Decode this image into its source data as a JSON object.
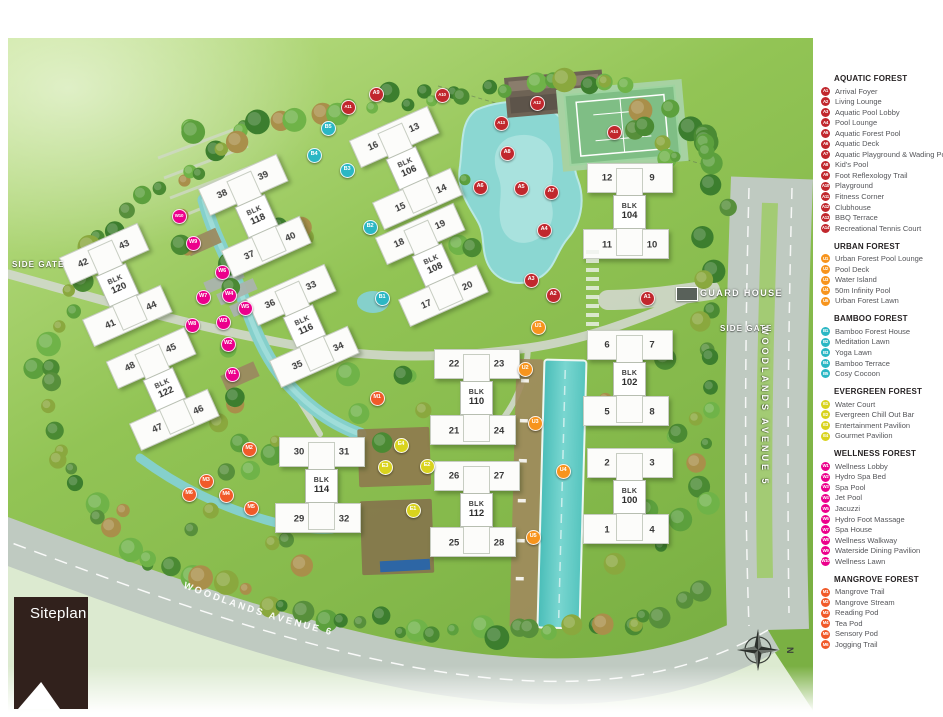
{
  "page": {
    "siteplan_label": "Siteplan"
  },
  "map": {
    "labels": {
      "guard_house": "GUARD HOUSE",
      "side_gate_right": "SIDE GATE",
      "side_gate_left": "SIDE GATE",
      "avenue5": "WOODLANDS AVENUE 5",
      "avenue6": "WOODLANDS AVENUE 6",
      "north": "N",
      "blk_prefix": "BLK"
    },
    "blocks": [
      {
        "number": "120",
        "x": 110,
        "y": 247,
        "rot": -24,
        "units": [
          "42",
          "43",
          "41",
          "44"
        ]
      },
      {
        "number": "122",
        "x": 157,
        "y": 351,
        "rot": -24,
        "units": [
          "48",
          "45",
          "47",
          "46"
        ]
      },
      {
        "number": "118",
        "x": 249,
        "y": 178,
        "rot": -24,
        "units": [
          "38",
          "39",
          "37",
          "40"
        ]
      },
      {
        "number": "116",
        "x": 297,
        "y": 288,
        "rot": -24,
        "units": [
          "36",
          "33",
          "35",
          "34"
        ]
      },
      {
        "number": "106",
        "x": 400,
        "y": 130,
        "rot": -24,
        "units": [
          "16",
          "13",
          "15",
          "14"
        ]
      },
      {
        "number": "108",
        "x": 426,
        "y": 227,
        "rot": -24,
        "units": [
          "18",
          "19",
          "17",
          "20"
        ]
      },
      {
        "number": "114",
        "x": 314,
        "y": 448,
        "rot": 0,
        "units": [
          "30",
          "31",
          "29",
          "32"
        ]
      },
      {
        "number": "110",
        "x": 469,
        "y": 360,
        "rot": 0,
        "units": [
          "22",
          "23",
          "21",
          "24"
        ]
      },
      {
        "number": "112",
        "x": 469,
        "y": 472,
        "rot": 0,
        "units": [
          "26",
          "27",
          "25",
          "28"
        ]
      },
      {
        "number": "104",
        "x": 622,
        "y": 174,
        "rot": 0,
        "units": [
          "12",
          "9",
          "11",
          "10"
        ]
      },
      {
        "number": "102",
        "x": 622,
        "y": 341,
        "rot": 0,
        "units": [
          "6",
          "7",
          "5",
          "8"
        ]
      },
      {
        "number": "100",
        "x": 622,
        "y": 459,
        "rot": 0,
        "units": [
          "2",
          "3",
          "1",
          "4"
        ]
      }
    ],
    "markers": [
      {
        "id": "A1",
        "cat": "aquatic",
        "x": 638,
        "y": 259
      },
      {
        "id": "A2",
        "cat": "aquatic",
        "x": 544,
        "y": 256
      },
      {
        "id": "A3",
        "cat": "aquatic",
        "x": 522,
        "y": 241
      },
      {
        "id": "A4",
        "cat": "aquatic",
        "x": 535,
        "y": 191
      },
      {
        "id": "A5",
        "cat": "aquatic",
        "x": 512,
        "y": 149
      },
      {
        "id": "A6",
        "cat": "aquatic",
        "x": 471,
        "y": 148
      },
      {
        "id": "A7",
        "cat": "aquatic",
        "x": 542,
        "y": 153
      },
      {
        "id": "A8",
        "cat": "aquatic",
        "x": 498,
        "y": 114
      },
      {
        "id": "A9",
        "cat": "aquatic",
        "x": 367,
        "y": 55
      },
      {
        "id": "A10",
        "cat": "aquatic",
        "x": 433,
        "y": 56
      },
      {
        "id": "A11",
        "cat": "aquatic",
        "x": 339,
        "y": 68
      },
      {
        "id": "A12",
        "cat": "aquatic",
        "x": 528,
        "y": 64
      },
      {
        "id": "A13",
        "cat": "aquatic",
        "x": 492,
        "y": 84
      },
      {
        "id": "A14",
        "cat": "aquatic",
        "x": 605,
        "y": 93
      },
      {
        "id": "U1",
        "cat": "urban",
        "x": 529,
        "y": 288
      },
      {
        "id": "U2",
        "cat": "urban",
        "x": 516,
        "y": 330
      },
      {
        "id": "U3",
        "cat": "urban",
        "x": 526,
        "y": 384
      },
      {
        "id": "U4",
        "cat": "urban",
        "x": 554,
        "y": 432
      },
      {
        "id": "U5",
        "cat": "urban",
        "x": 524,
        "y": 498
      },
      {
        "id": "B1",
        "cat": "bamboo",
        "x": 373,
        "y": 259
      },
      {
        "id": "B2",
        "cat": "bamboo",
        "x": 361,
        "y": 188
      },
      {
        "id": "B3",
        "cat": "bamboo",
        "x": 338,
        "y": 131
      },
      {
        "id": "B4",
        "cat": "bamboo",
        "x": 305,
        "y": 116
      },
      {
        "id": "B5",
        "cat": "bamboo",
        "x": 319,
        "y": 89
      },
      {
        "id": "E1",
        "cat": "evergreen",
        "x": 404,
        "y": 471
      },
      {
        "id": "E2",
        "cat": "evergreen",
        "x": 418,
        "y": 427
      },
      {
        "id": "E3",
        "cat": "evergreen",
        "x": 376,
        "y": 428
      },
      {
        "id": "E4",
        "cat": "evergreen",
        "x": 392,
        "y": 406
      },
      {
        "id": "W1",
        "cat": "wellness",
        "x": 223,
        "y": 335
      },
      {
        "id": "W2",
        "cat": "wellness",
        "x": 219,
        "y": 305
      },
      {
        "id": "W3",
        "cat": "wellness",
        "x": 214,
        "y": 283
      },
      {
        "id": "W4",
        "cat": "wellness",
        "x": 220,
        "y": 256
      },
      {
        "id": "W5",
        "cat": "wellness",
        "x": 236,
        "y": 269
      },
      {
        "id": "W6",
        "cat": "wellness",
        "x": 213,
        "y": 233
      },
      {
        "id": "W7",
        "cat": "wellness",
        "x": 194,
        "y": 258
      },
      {
        "id": "W8",
        "cat": "wellness",
        "x": 183,
        "y": 286
      },
      {
        "id": "W9",
        "cat": "wellness",
        "x": 184,
        "y": 204
      },
      {
        "id": "W10",
        "cat": "wellness",
        "x": 170,
        "y": 177
      },
      {
        "id": "M1",
        "cat": "mangrove",
        "x": 368,
        "y": 359
      },
      {
        "id": "M2",
        "cat": "mangrove",
        "x": 240,
        "y": 410
      },
      {
        "id": "M3",
        "cat": "mangrove",
        "x": 197,
        "y": 442
      },
      {
        "id": "M4",
        "cat": "mangrove",
        "x": 217,
        "y": 456
      },
      {
        "id": "M5",
        "cat": "mangrove",
        "x": 242,
        "y": 469
      },
      {
        "id": "M6",
        "cat": "mangrove",
        "x": 180,
        "y": 455
      }
    ]
  },
  "legend": {
    "colors": {
      "aquatic": "#c1272d",
      "urban": "#f7941d",
      "bamboo": "#2bb7c4",
      "evergreen": "#d9d31e",
      "wellness": "#ec008c",
      "mangrove": "#f15a29"
    },
    "sections": [
      {
        "title": "AQUATIC FOREST",
        "cat": "aquatic",
        "items": [
          {
            "id": "A1",
            "label": "Arrival Foyer"
          },
          {
            "id": "A2",
            "label": "Living Lounge"
          },
          {
            "id": "A3",
            "label": "Aquatic Pool Lobby"
          },
          {
            "id": "A4",
            "label": "Pool Lounge"
          },
          {
            "id": "A5",
            "label": "Aquatic Forest Pool"
          },
          {
            "id": "A6",
            "label": "Aquatic Deck"
          },
          {
            "id": "A7",
            "label": "Aquatic Playground & Wading Pool"
          },
          {
            "id": "A8",
            "label": "Kid's Pool"
          },
          {
            "id": "A9",
            "label": "Foot Reflexology Trail"
          },
          {
            "id": "A10",
            "label": "Playground"
          },
          {
            "id": "A11",
            "label": "Fitness Corner"
          },
          {
            "id": "A12",
            "label": "Clubhouse"
          },
          {
            "id": "A13",
            "label": "BBQ Terrace"
          },
          {
            "id": "A14",
            "label": "Recreational Tennis Court"
          }
        ]
      },
      {
        "title": "URBAN FOREST",
        "cat": "urban",
        "items": [
          {
            "id": "U1",
            "label": "Urban Forest Pool Lounge"
          },
          {
            "id": "U2",
            "label": "Pool Deck"
          },
          {
            "id": "U3",
            "label": "Water Island"
          },
          {
            "id": "U4",
            "label": "50m Infinity Pool"
          },
          {
            "id": "U5",
            "label": "Urban Forest Lawn"
          }
        ]
      },
      {
        "title": "BAMBOO FOREST",
        "cat": "bamboo",
        "items": [
          {
            "id": "B1",
            "label": "Bamboo Forest House"
          },
          {
            "id": "B2",
            "label": "Meditation Lawn"
          },
          {
            "id": "B3",
            "label": "Yoga Lawn"
          },
          {
            "id": "B4",
            "label": "Bamboo Terrace"
          },
          {
            "id": "B5",
            "label": "Cosy Cocoon"
          }
        ]
      },
      {
        "title": "EVERGREEN FOREST",
        "cat": "evergreen",
        "items": [
          {
            "id": "E1",
            "label": "Water Court"
          },
          {
            "id": "E2",
            "label": "Evergreen Chill Out Bar"
          },
          {
            "id": "E3",
            "label": "Entertainment Pavilion"
          },
          {
            "id": "E4",
            "label": "Gourmet Pavilion"
          }
        ]
      },
      {
        "title": "WELLNESS FOREST",
        "cat": "wellness",
        "items": [
          {
            "id": "W1",
            "label": "Wellness Lobby"
          },
          {
            "id": "W2",
            "label": "Hydro Spa Bed"
          },
          {
            "id": "W3",
            "label": "Spa Pool"
          },
          {
            "id": "W4",
            "label": "Jet Pool"
          },
          {
            "id": "W5",
            "label": "Jacuzzi"
          },
          {
            "id": "W6",
            "label": "Hydro Foot Massage"
          },
          {
            "id": "W7",
            "label": "Spa House"
          },
          {
            "id": "W8",
            "label": "Wellness Walkway"
          },
          {
            "id": "W9",
            "label": "Waterside Dining Pavilion"
          },
          {
            "id": "W10",
            "label": "Wellness Lawn"
          }
        ]
      },
      {
        "title": "MANGROVE FOREST",
        "cat": "mangrove",
        "items": [
          {
            "id": "M1",
            "label": "Mangrove Trail"
          },
          {
            "id": "M2",
            "label": "Mangrove Stream"
          },
          {
            "id": "M3",
            "label": "Reading Pod"
          },
          {
            "id": "M4",
            "label": "Tea Pod"
          },
          {
            "id": "M5",
            "label": "Sensory Pod"
          },
          {
            "id": "M6",
            "label": "Jogging Trail"
          }
        ]
      }
    ]
  }
}
